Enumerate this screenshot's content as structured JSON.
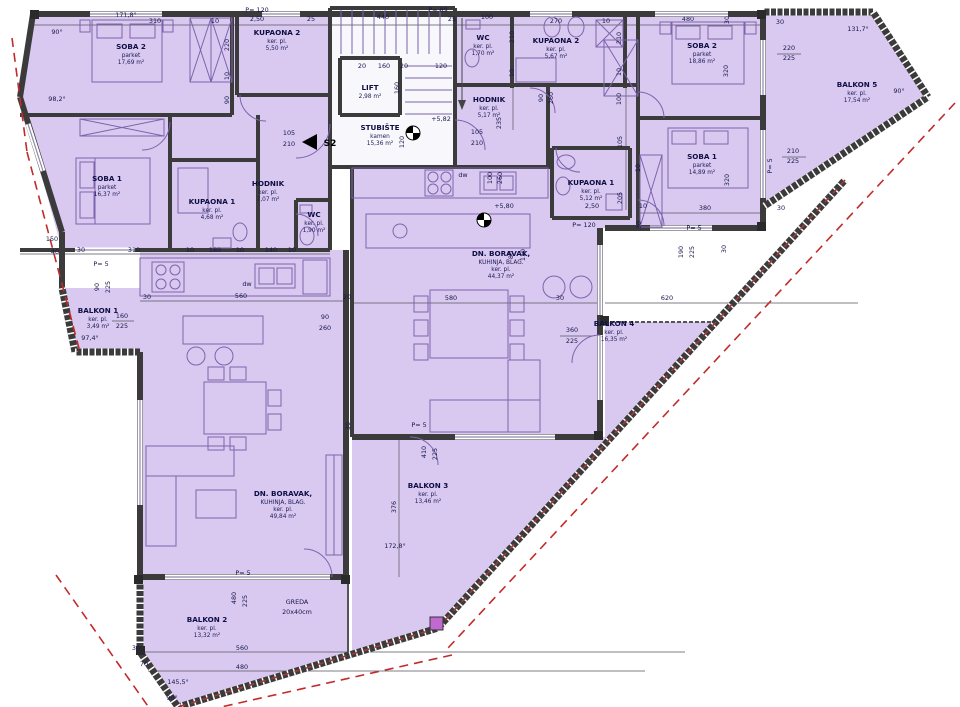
{
  "drawing": {
    "type": "floor-plan",
    "language": "hr",
    "entrance_marker": "S2"
  },
  "colors": {
    "floor": "#d9c9f0",
    "core_floor": "#f8f7fc",
    "wall": "#3b3b3b",
    "furniture_line": "#7d63ad",
    "dimension_text": "#15154a",
    "boundary_dash": "#c22b2b",
    "junction_post": "#c06ad0"
  },
  "room_labels": [
    {
      "id": "left-soba2",
      "x": 131,
      "y": 49,
      "lines": [
        "SOBA 2",
        "parket",
        "17,69 m²"
      ]
    },
    {
      "id": "left-kupaona2",
      "x": 277,
      "y": 35,
      "lines": [
        "KUPAONA 2",
        "ker. pl.",
        "5,50 m²"
      ]
    },
    {
      "id": "left-soba1",
      "x": 107,
      "y": 181,
      "lines": [
        "SOBA 1",
        "parket",
        "16,37 m²"
      ]
    },
    {
      "id": "left-kupaona1",
      "x": 212,
      "y": 204,
      "lines": [
        "KUPAONA 1",
        "ker. pl.",
        "4,68 m²"
      ]
    },
    {
      "id": "left-hodnik",
      "x": 268,
      "y": 186,
      "lines": [
        "HODNIK",
        "ker. pl.",
        "7,07 m²"
      ]
    },
    {
      "id": "left-wc",
      "x": 314,
      "y": 217,
      "lines": [
        "WC",
        "ker. pl.",
        "1,90 m²"
      ]
    },
    {
      "id": "left-boravak",
      "x": 283,
      "y": 496,
      "lines": [
        "DN. BORAVAK,",
        "KUHINJA, BLAG.",
        "ker. pl.",
        "49,84 m²"
      ]
    },
    {
      "id": "balkon1",
      "x": 98,
      "y": 313,
      "lines": [
        "BALKON 1",
        "ker. pl.",
        "3,49 m²"
      ]
    },
    {
      "id": "balkon2",
      "x": 207,
      "y": 622,
      "lines": [
        "BALKON 2",
        "ker. pl.",
        "13,32 m²"
      ]
    },
    {
      "id": "lift",
      "x": 370,
      "y": 90,
      "lines": [
        "LIFT",
        "2,98 m²"
      ]
    },
    {
      "id": "stubiste",
      "x": 380,
      "y": 130,
      "lines": [
        "STUBIŠTE",
        "kamen",
        "15,36 m²"
      ]
    },
    {
      "id": "right-wc",
      "x": 483,
      "y": 40,
      "lines": [
        "WC",
        "ker. pl.",
        "1,70 m²"
      ]
    },
    {
      "id": "right-kupaona2",
      "x": 556,
      "y": 43,
      "lines": [
        "KUPAONA 2",
        "ker. pl.",
        "5,67 m²"
      ]
    },
    {
      "id": "right-soba2",
      "x": 702,
      "y": 48,
      "lines": [
        "SOBA 2",
        "parket",
        "18,86 m²"
      ]
    },
    {
      "id": "right-hodnik",
      "x": 489,
      "y": 102,
      "lines": [
        "HODNIK",
        "ker. pl.",
        "5,17 m²"
      ]
    },
    {
      "id": "right-kupaona1",
      "x": 591,
      "y": 185,
      "lines": [
        "KUPAONA 1",
        "ker. pl.",
        "5,12 m²"
      ]
    },
    {
      "id": "right-soba1",
      "x": 702,
      "y": 159,
      "lines": [
        "SOBA 1",
        "parket",
        "14,89 m²"
      ]
    },
    {
      "id": "right-boravak",
      "x": 501,
      "y": 256,
      "lines": [
        "DN. BORAVAK,",
        "KUHINJA, BLAG.",
        "ker. pl.",
        "44,37 m²"
      ]
    },
    {
      "id": "balkon3",
      "x": 428,
      "y": 488,
      "lines": [
        "BALKON 3",
        "ker. pl.",
        "13,46 m²"
      ]
    },
    {
      "id": "balkon4",
      "x": 614,
      "y": 326,
      "lines": [
        "BALKON 4",
        "ker. pl.",
        "16,35 m²"
      ]
    },
    {
      "id": "balkon5",
      "x": 857,
      "y": 87,
      "lines": [
        "BALKON 5",
        "ker. pl.",
        "17,54 m²"
      ]
    }
  ],
  "dim_labels": [
    {
      "t": "90°",
      "x": 57,
      "y": 34
    },
    {
      "t": "171,8°",
      "x": 126,
      "y": 17
    },
    {
      "t": "310",
      "x": 155,
      "y": 23
    },
    {
      "t": "10",
      "x": 215,
      "y": 23
    },
    {
      "t": "P= 120",
      "x": 257,
      "y": 12
    },
    {
      "t": "2,50",
      "x": 257,
      "y": 21
    },
    {
      "t": "25",
      "x": 311,
      "y": 21
    },
    {
      "t": "440",
      "x": 383,
      "y": 19
    },
    {
      "t": "P= 89",
      "x": 438,
      "y": 12
    },
    {
      "t": "25",
      "x": 452,
      "y": 21
    },
    {
      "t": "100",
      "x": 487,
      "y": 19
    },
    {
      "t": "270",
      "x": 556,
      "y": 23
    },
    {
      "t": "10",
      "x": 606,
      "y": 23
    },
    {
      "t": "480",
      "x": 688,
      "y": 21
    },
    {
      "t": "30",
      "x": 729,
      "y": 20,
      "r": -90
    },
    {
      "t": "30",
      "x": 780,
      "y": 24
    },
    {
      "t": "220",
      "x": 789,
      "y": 50
    },
    {
      "t": "225",
      "x": 789,
      "y": 60
    },
    {
      "t": "131,7°",
      "x": 858,
      "y": 31
    },
    {
      "t": "90°",
      "x": 899,
      "y": 93
    },
    {
      "t": "220",
      "x": 229,
      "y": 45,
      "r": -90
    },
    {
      "t": "10",
      "x": 229,
      "y": 76,
      "r": -90
    },
    {
      "t": "90",
      "x": 229,
      "y": 100,
      "r": -90
    },
    {
      "t": "98,2°",
      "x": 57,
      "y": 101
    },
    {
      "t": "150",
      "x": 52,
      "y": 241
    },
    {
      "t": "40",
      "x": 55,
      "y": 254
    },
    {
      "t": "90",
      "x": 99,
      "y": 287,
      "r": -90
    },
    {
      "t": "225",
      "x": 110,
      "y": 287,
      "r": -90
    },
    {
      "t": "97,4°",
      "x": 90,
      "y": 340
    },
    {
      "t": "20",
      "x": 362,
      "y": 68
    },
    {
      "t": "160",
      "x": 384,
      "y": 68
    },
    {
      "t": "20",
      "x": 404,
      "y": 68
    },
    {
      "t": "120",
      "x": 441,
      "y": 68
    },
    {
      "t": "160",
      "x": 399,
      "y": 88,
      "r": -90
    },
    {
      "t": "120",
      "x": 404,
      "y": 142,
      "r": -90
    },
    {
      "t": "105",
      "x": 289,
      "y": 135
    },
    {
      "t": "210",
      "x": 289,
      "y": 146
    },
    {
      "t": "+5,82",
      "x": 441,
      "y": 121
    },
    {
      "t": "S2",
      "x": 330,
      "y": 146,
      "b": 1
    },
    {
      "t": "105",
      "x": 477,
      "y": 134
    },
    {
      "t": "210",
      "x": 477,
      "y": 145
    },
    {
      "t": "210",
      "x": 514,
      "y": 37,
      "r": -90
    },
    {
      "t": "10",
      "x": 514,
      "y": 73,
      "r": -90
    },
    {
      "t": "235",
      "x": 501,
      "y": 123,
      "r": -90
    },
    {
      "t": "90",
      "x": 543,
      "y": 98,
      "r": -90
    },
    {
      "t": "260",
      "x": 553,
      "y": 98,
      "r": -90
    },
    {
      "t": "210",
      "x": 621,
      "y": 38,
      "r": -90
    },
    {
      "t": "10",
      "x": 621,
      "y": 72,
      "r": -90
    },
    {
      "t": "100",
      "x": 621,
      "y": 99,
      "r": -90
    },
    {
      "t": "320",
      "x": 728,
      "y": 71,
      "r": -90
    },
    {
      "t": "105",
      "x": 622,
      "y": 142,
      "r": -90
    },
    {
      "t": "205",
      "x": 622,
      "y": 198,
      "r": -90
    },
    {
      "t": "10",
      "x": 643,
      "y": 208
    },
    {
      "t": "380",
      "x": 705,
      "y": 210
    },
    {
      "t": "320",
      "x": 729,
      "y": 180,
      "r": -90
    },
    {
      "t": "30",
      "x": 781,
      "y": 210
    },
    {
      "t": "210",
      "x": 793,
      "y": 153
    },
    {
      "t": "225",
      "x": 793,
      "y": 163
    },
    {
      "t": "P= 5",
      "x": 772,
      "y": 166,
      "r": -90
    },
    {
      "t": "P= 5",
      "x": 694,
      "y": 230
    },
    {
      "t": "190",
      "x": 683,
      "y": 252,
      "r": -90
    },
    {
      "t": "225",
      "x": 694,
      "y": 252,
      "r": -90
    },
    {
      "t": "30",
      "x": 726,
      "y": 249,
      "r": -90
    },
    {
      "t": "10",
      "x": 640,
      "y": 168,
      "r": -90
    },
    {
      "t": "30",
      "x": 641,
      "y": 225,
      "r": -90
    },
    {
      "t": "2,50",
      "x": 592,
      "y": 208
    },
    {
      "t": "P= 120",
      "x": 584,
      "y": 227
    },
    {
      "t": "+5,80",
      "x": 504,
      "y": 208
    },
    {
      "t": "100",
      "x": 492,
      "y": 178,
      "r": -90
    },
    {
      "t": "260",
      "x": 502,
      "y": 178,
      "r": -90
    },
    {
      "t": "80",
      "x": 513,
      "y": 255,
      "r": -90
    },
    {
      "t": "110",
      "x": 525,
      "y": 255,
      "r": -90
    },
    {
      "t": "580",
      "x": 451,
      "y": 300
    },
    {
      "t": "30",
      "x": 560,
      "y": 300
    },
    {
      "t": "620",
      "x": 667,
      "y": 300
    },
    {
      "t": "360",
      "x": 572,
      "y": 332
    },
    {
      "t": "225",
      "x": 572,
      "y": 343
    },
    {
      "t": "30",
      "x": 81,
      "y": 252
    },
    {
      "t": "310",
      "x": 134,
      "y": 252
    },
    {
      "t": "10",
      "x": 190,
      "y": 252
    },
    {
      "t": "180",
      "x": 215,
      "y": 252
    },
    {
      "t": "10",
      "x": 240,
      "y": 252
    },
    {
      "t": "140",
      "x": 271,
      "y": 252
    },
    {
      "t": "10",
      "x": 292,
      "y": 252
    },
    {
      "t": "P= 5",
      "x": 101,
      "y": 266
    },
    {
      "t": "30",
      "x": 147,
      "y": 299
    },
    {
      "t": "560",
      "x": 241,
      "y": 298
    },
    {
      "t": "20",
      "x": 347,
      "y": 299
    },
    {
      "t": "90",
      "x": 325,
      "y": 319
    },
    {
      "t": "260",
      "x": 325,
      "y": 330
    },
    {
      "t": "160",
      "x": 122,
      "y": 318
    },
    {
      "t": "225",
      "x": 122,
      "y": 328
    },
    {
      "t": "dw",
      "x": 247,
      "y": 286
    },
    {
      "t": "dw",
      "x": 463,
      "y": 177
    },
    {
      "t": "30",
      "x": 350,
      "y": 426,
      "r": -90
    },
    {
      "t": "P= 5",
      "x": 419,
      "y": 427
    },
    {
      "t": "410",
      "x": 426,
      "y": 452,
      "r": -90
    },
    {
      "t": "225",
      "x": 437,
      "y": 454,
      "r": -90
    },
    {
      "t": "376",
      "x": 396,
      "y": 507,
      "r": -90
    },
    {
      "t": "172,8°",
      "x": 395,
      "y": 548
    },
    {
      "t": "480",
      "x": 236,
      "y": 598,
      "r": -90
    },
    {
      "t": "225",
      "x": 247,
      "y": 601,
      "r": -90
    },
    {
      "t": "P= 5",
      "x": 243,
      "y": 575
    },
    {
      "t": "GREDA",
      "x": 297,
      "y": 604
    },
    {
      "t": "20x40cm",
      "x": 297,
      "y": 614
    },
    {
      "t": "30",
      "x": 136,
      "y": 650
    },
    {
      "t": "560",
      "x": 242,
      "y": 650
    },
    {
      "t": "70",
      "x": 144,
      "y": 666
    },
    {
      "t": "480",
      "x": 242,
      "y": 669
    },
    {
      "t": "145,5°",
      "x": 178,
      "y": 684
    },
    {
      "t": "90°",
      "x": 172,
      "y": 700
    }
  ]
}
